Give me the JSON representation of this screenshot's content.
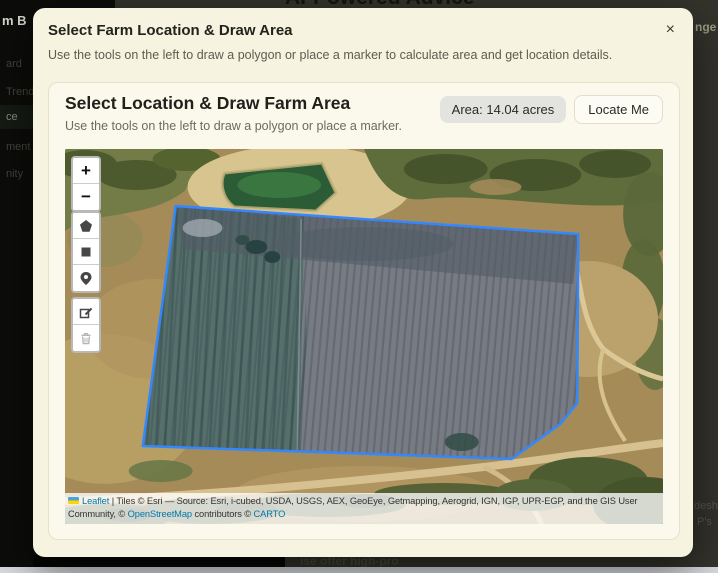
{
  "background": {
    "page_title_partial": "AI-Powered Advice",
    "sidebar_logo_partial": "m B",
    "sidebar_items": [
      {
        "label": "ard",
        "active": false
      },
      {
        "label": "Trend",
        "active": false
      },
      {
        "label": "ce",
        "active": true
      },
      {
        "label": "ment",
        "active": false
      },
      {
        "label": "nity",
        "active": false
      }
    ],
    "top_right_partial": "nge",
    "bottom_right_partial_1": "desh",
    "bottom_right_partial_2": "P's",
    "bottom_center_partial": "ise offer high-pro"
  },
  "modal": {
    "title": "Select Farm Location & Draw Area",
    "subtitle": "Use the tools on the left to draw a polygon or place a marker to calculate area and get location details.",
    "close_label": "×"
  },
  "panel": {
    "title": "Select Location & Draw Farm Area",
    "subtitle": "Use the tools on the left to draw a polygon or place a marker.",
    "area_badge": "Area: 14.04 acres",
    "locate_button": "Locate Me"
  },
  "map": {
    "zoom_in_label": "+",
    "zoom_out_label": "−",
    "polygon_color": "#3388ff",
    "polygon_points": "111,57 515,85 514,254 497,275 448,310 78,297",
    "attribution": {
      "leaflet": "Leaflet",
      "separator": "|",
      "tiles": "Tiles © Esri — Source: Esri, i-cubed, USDA, USGS, AEX, GeoEye, Getmapping, Aerogrid, IGN, IGP, UPR-EGP, and the GIS User Community, ©",
      "osm": "OpenStreetMap",
      "contributors": "contributors ©",
      "carto": "CARTO"
    }
  }
}
